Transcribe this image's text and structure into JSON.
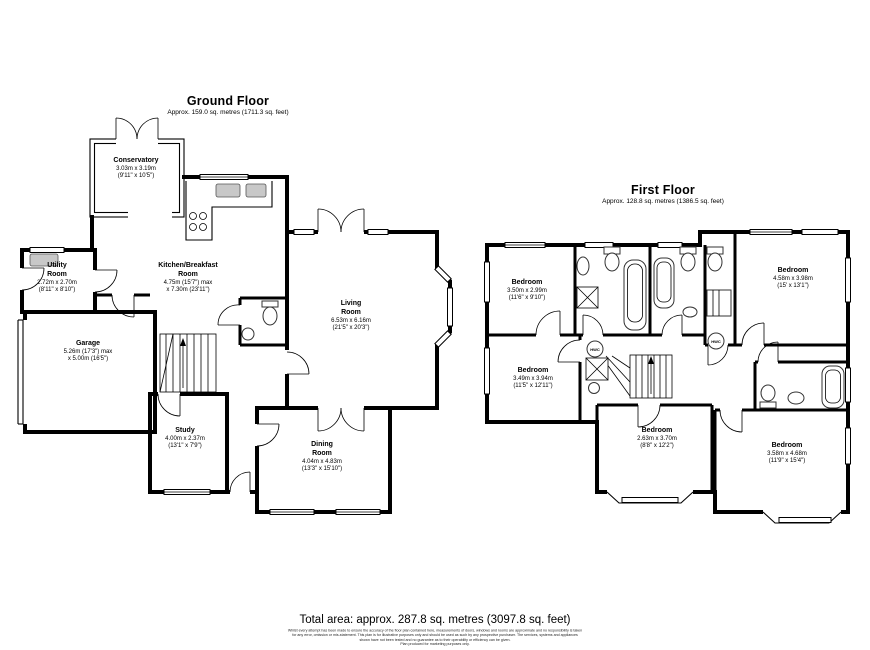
{
  "colors": {
    "walls": "#000000",
    "fixture_grey": "#c8c8c8",
    "background": "#ffffff"
  },
  "ground_floor": {
    "title": "Ground Floor",
    "subtitle": "Approx. 159.0 sq. metres (1711.3 sq. feet)",
    "rooms": {
      "conservatory": {
        "name": "Conservatory",
        "dims": "3.03m x 3.19m\n(9'11\" x 10'5\")"
      },
      "utility": {
        "name": "Utility\nRoom",
        "dims": "2.72m x 2.70m\n(8'11\" x 8'10\")"
      },
      "garage": {
        "name": "Garage",
        "dims": "5.26m (17'3\") max\nx 5.00m (16'5\")"
      },
      "kitchen": {
        "name": "Kitchen/Breakfast\nRoom",
        "dims": "4.75m (15'7\") max\nx 7.30m (23'11\")"
      },
      "living": {
        "name": "Living\nRoom",
        "dims": "6.53m x 6.16m\n(21'5\" x 20'3\")"
      },
      "study": {
        "name": "Study",
        "dims": "4.00m x 2.37m\n(13'1\" x 7'9\")"
      },
      "dining": {
        "name": "Dining\nRoom",
        "dims": "4.04m x 4.83m\n(13'3\" x 15'10\")"
      }
    }
  },
  "first_floor": {
    "title": "First Floor",
    "subtitle": "Approx. 128.8 sq. metres (1386.5 sq. feet)",
    "hwc_label": "HWC",
    "rooms": {
      "bedroom_top_left": {
        "name": "Bedroom",
        "dims": "3.50m x 2.99m\n(11'6\" x 9'10\")"
      },
      "bedroom_top_right": {
        "name": "Bedroom",
        "dims": "4.58m x 3.98m\n(15' x 13'1\")"
      },
      "bedroom_mid_left": {
        "name": "Bedroom",
        "dims": "3.49m x 3.94m\n(11'5\" x 12'11\")"
      },
      "bedroom_bottom_mid": {
        "name": "Bedroom",
        "dims": "2.63m x 3.70m\n(8'8\" x 12'2\")"
      },
      "bedroom_bottom_right": {
        "name": "Bedroom",
        "dims": "3.58m x 4.68m\n(11'9\" x 15'4\")"
      }
    }
  },
  "footer": {
    "total_area": "Total area: approx. 287.8 sq. metres (3097.8 sq. feet)",
    "disclaimer": "Whilst every attempt has been made to ensure the accuracy of the floor plan contained here, measurements of doors, windows and rooms are approximate and no responsibility is taken\nfor any error, omission or mis-statement. This plan is for illustrative purposes only and should be used as such by any prospective purchaser. The services, systems and appliances\nshown have not been tested and no guarantee as to their operability or efficiency can be given.\nPlan produced for marketing purposes only."
  }
}
